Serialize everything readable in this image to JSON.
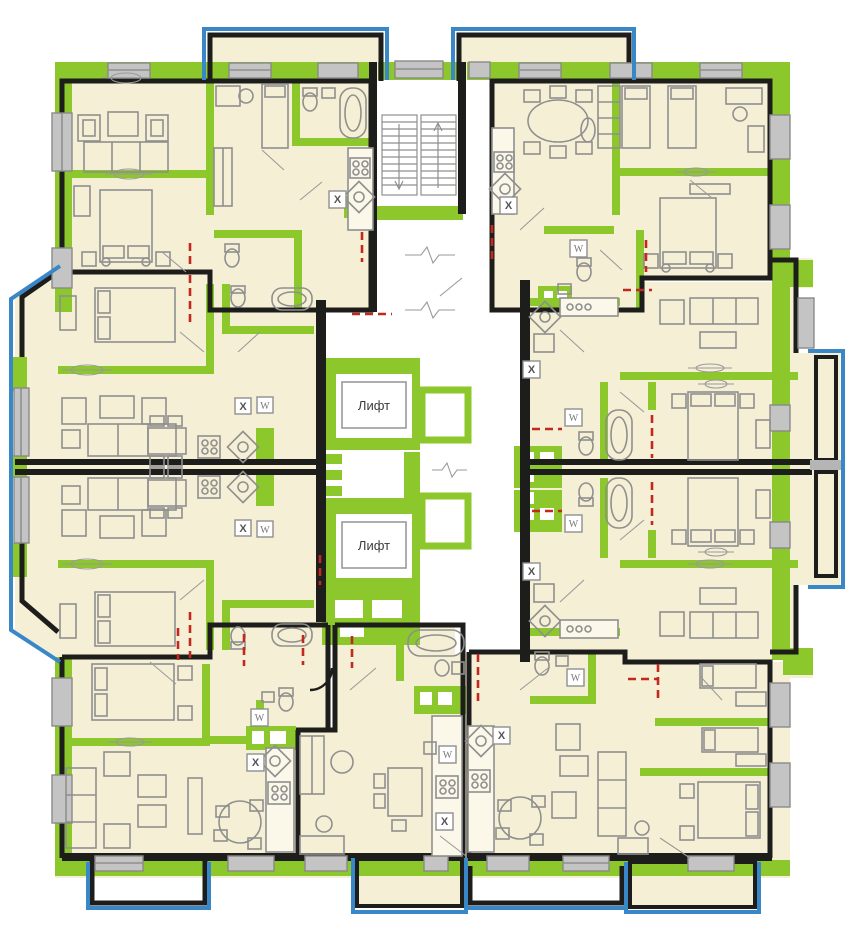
{
  "meta": {
    "drawing_type": "residential-building-floor-plan",
    "language": "ru"
  },
  "labels": {
    "elevator": "Лифт",
    "stove_mark": "X",
    "washer_mark": "W"
  },
  "elevators": [
    {
      "label": "Лифт"
    },
    {
      "label": "Лифт"
    }
  ],
  "colors": {
    "background": "#FFFFFF",
    "floor_fill": "#F5F0D5",
    "wall_green": "#8CC72B",
    "wall_black": "#1D1D1B",
    "balcony_blue": "#3A87C8",
    "window_gray": "#C4C4C4",
    "window_gray_stroke": "#8A8A8A",
    "furniture_stroke": "#8F8F8F",
    "door_red": "#C2281E",
    "label_text": "#3C3C3C"
  }
}
